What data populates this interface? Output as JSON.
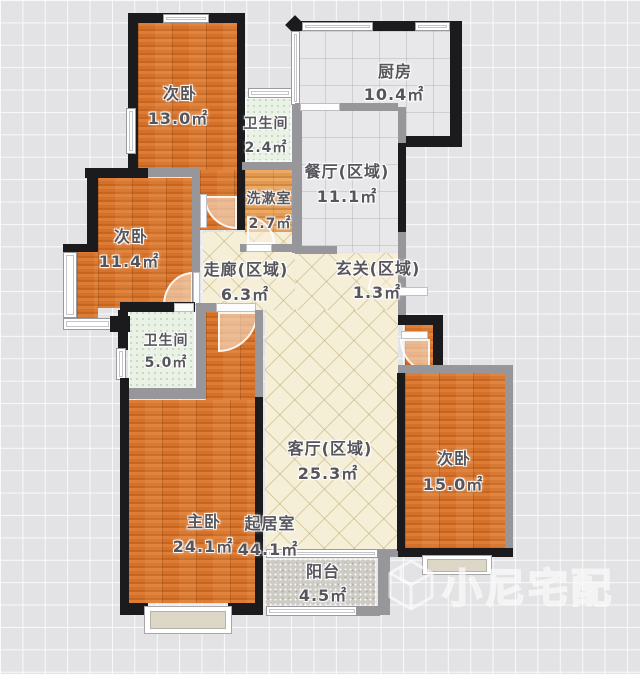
{
  "plan": {
    "title": "apartment-floor-plan",
    "unit": "㎡",
    "rooms": [
      {
        "id": "bedroom-top",
        "name": "次卧",
        "area": "13.0㎡"
      },
      {
        "id": "bathroom-small",
        "name": "卫生间",
        "area": "2.4㎡"
      },
      {
        "id": "kitchen",
        "name": "厨房",
        "area": "10.4㎡"
      },
      {
        "id": "dining-zone",
        "name": "餐厅(区域)",
        "area": "11.1㎡"
      },
      {
        "id": "washroom",
        "name": "洗漱室",
        "area": "2.7㎡"
      },
      {
        "id": "bedroom-left",
        "name": "次卧",
        "area": "11.4㎡"
      },
      {
        "id": "corridor-zone",
        "name": "走廊(区域)",
        "area": "6.3㎡"
      },
      {
        "id": "entry-zone",
        "name": "玄关(区域)",
        "area": "1.3㎡"
      },
      {
        "id": "bathroom-master",
        "name": "卫生间",
        "area": "5.0㎡"
      },
      {
        "id": "living-zone",
        "name": "客厅(区域)",
        "area": "25.3㎡"
      },
      {
        "id": "master-bedroom",
        "name": "主卧",
        "area": "24.1㎡"
      },
      {
        "id": "living-room",
        "name": "起居室",
        "area": "44.1㎡"
      },
      {
        "id": "bedroom-right",
        "name": "次卧",
        "area": "15.0㎡"
      },
      {
        "id": "balcony",
        "name": "阳台",
        "area": "4.5㎡"
      }
    ],
    "watermark": {
      "brand": "小尼宅配",
      "logo": "cube-logo"
    },
    "palette": {
      "wood_floor": "#d4702a",
      "wood_floor_light": "#e09a55",
      "bath_tile": "#eaf2e6",
      "gray_tile": "#e8e8ea",
      "cream_tile": "#f5efd8",
      "balcony_floor": "#cecbc5",
      "exterior_wall": "#1b1b1d",
      "interior_wall": "#97969a",
      "label_text": "#56555b"
    }
  }
}
